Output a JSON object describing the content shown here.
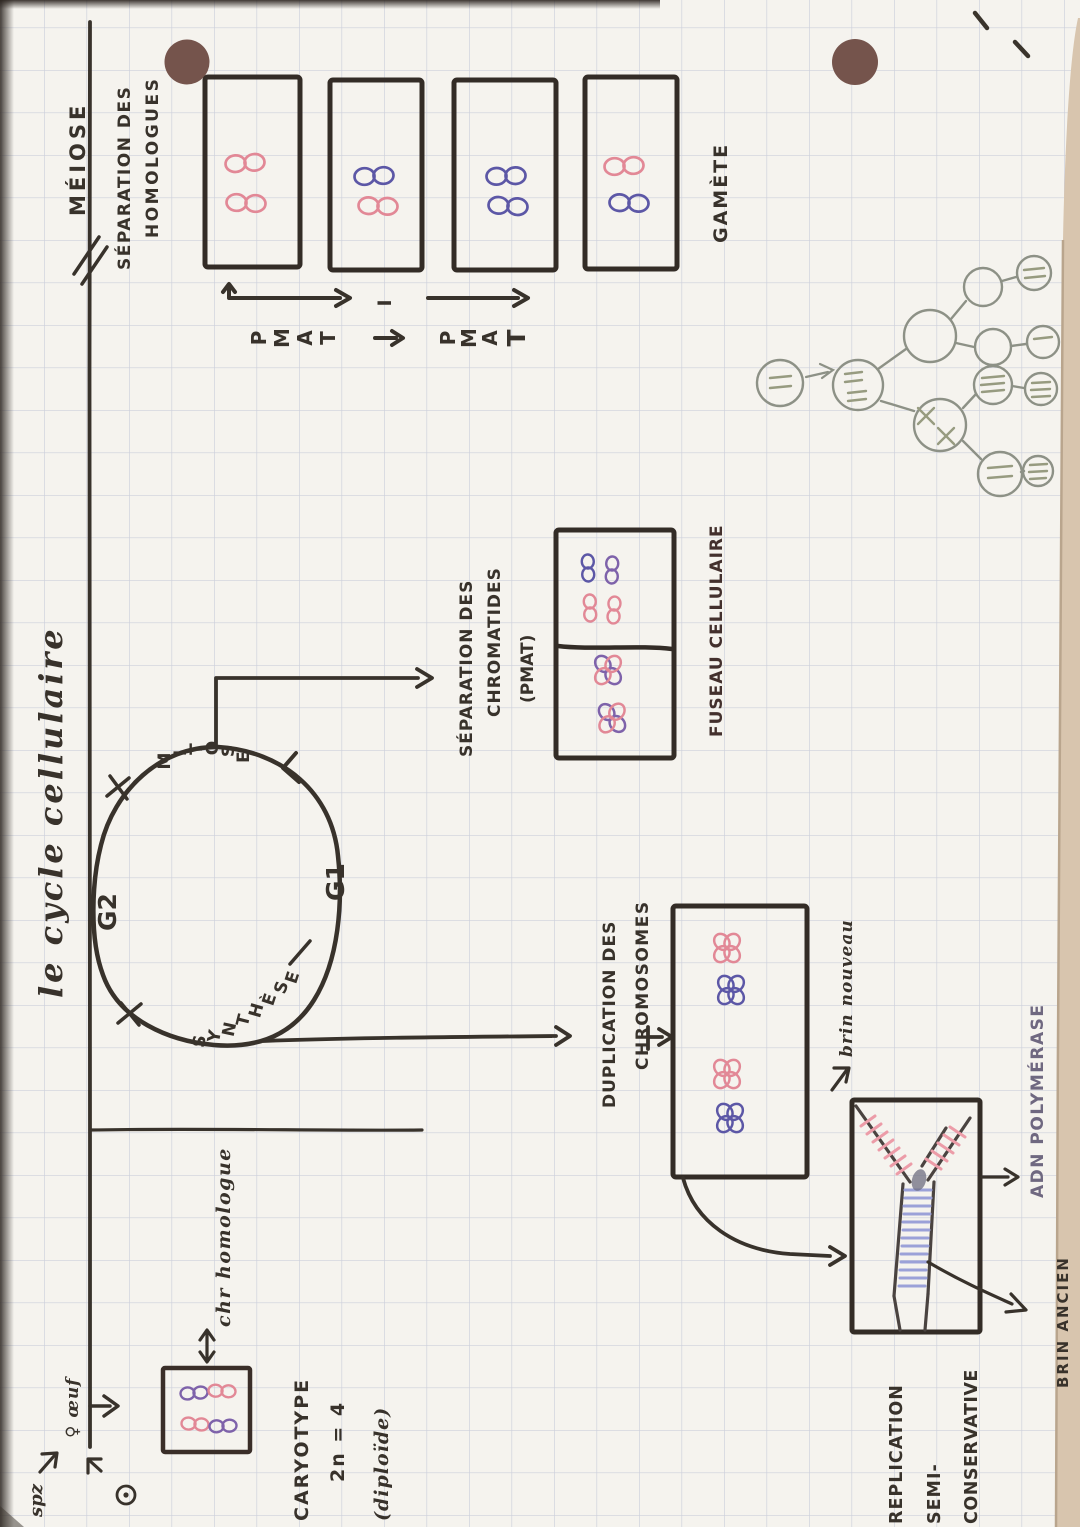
{
  "page": {
    "title": "le cycle cellulaire"
  },
  "colors": {
    "paper": "#f5f3ee",
    "grid": "#aab1cc",
    "ink": "#38322b",
    "pink": "#e28896",
    "blue": "#5c57a6",
    "purple": "#7e62aa",
    "pencil": "#8d9186",
    "hole": "#75544c",
    "lavender": "#9ba1d8",
    "new_strand_pink": "#ec9ca8",
    "poly_ink": "#6f6880"
  },
  "timeline": {
    "meiose": "MÉIOSE",
    "separation1": "SÉPARATION DES",
    "separation2": "HOMOLOGUES",
    "gamete": "GAMÈTE"
  },
  "meiosis": {
    "letters": [
      "P",
      "M",
      "A",
      "T"
    ],
    "div1": "I"
  },
  "cycle": {
    "g2": "G2",
    "g1": "G1",
    "mitose": [
      "M",
      "I",
      "T",
      "O",
      "S",
      "E"
    ],
    "synthese": [
      "S",
      "Y",
      "N",
      "T",
      "H",
      "È",
      "S",
      "E"
    ],
    "sep1": "SÉPARATION DES",
    "sep2": "CHROMATIDES",
    "sep3": "(PMAT)",
    "fuseau": "FUSEAU CELLULAIRE"
  },
  "duplication": {
    "line1": "DUPLICATION DES",
    "line2": "CHROMOSOMES"
  },
  "replication": {
    "brin_nouveau": "brin nouveau",
    "brin_ancien": "BRIN ANCIEN",
    "adn_polymerase": "ADN POLYMÉRASE",
    "caption1": "REPLICATION",
    "caption2": "SEMI-",
    "caption3": "CONSERVATIVE"
  },
  "origin": {
    "oeuf": "♀ œuf",
    "spz": "spz",
    "caryotype": "CARYOTYPE",
    "ploidie": "2n = 4",
    "diploide": "(diploïde)",
    "chr_homologue": "chr homologue"
  }
}
